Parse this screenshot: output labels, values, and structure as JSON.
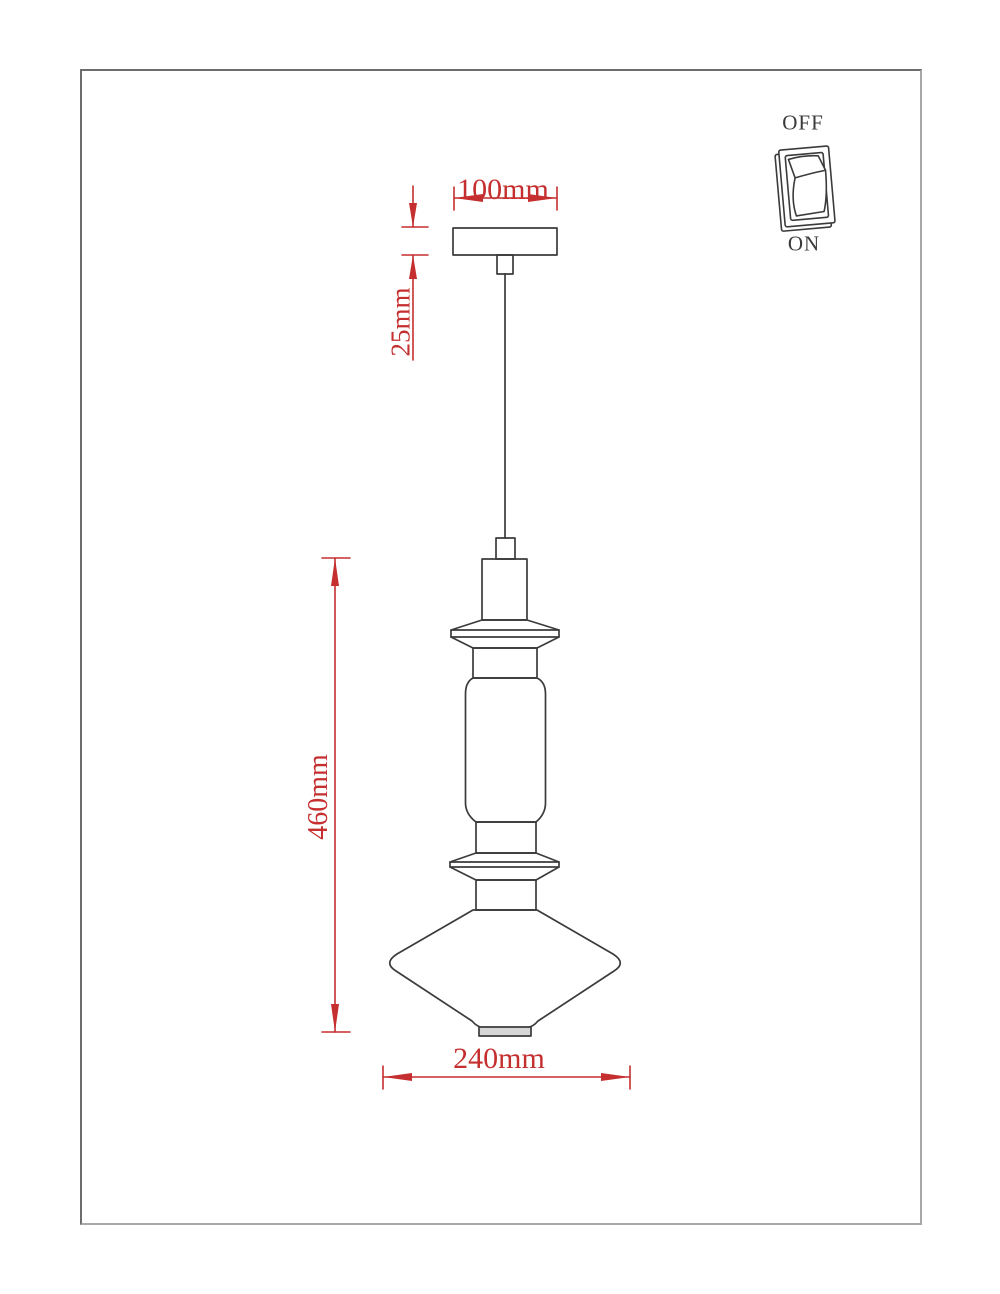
{
  "colors": {
    "dimension_red": "#c52f2f",
    "outline_dark": "#3b3b3b",
    "frame_gray": "#6d6d6d",
    "shade_lip_fill": "#d6d6d6"
  },
  "drawing": {
    "dimensions": {
      "canopy_width": "100mm",
      "canopy_drop": "25mm",
      "fixture_height": "460mm",
      "shade_diameter": "240mm"
    },
    "switch": {
      "off": "OFF",
      "on": "ON"
    }
  }
}
